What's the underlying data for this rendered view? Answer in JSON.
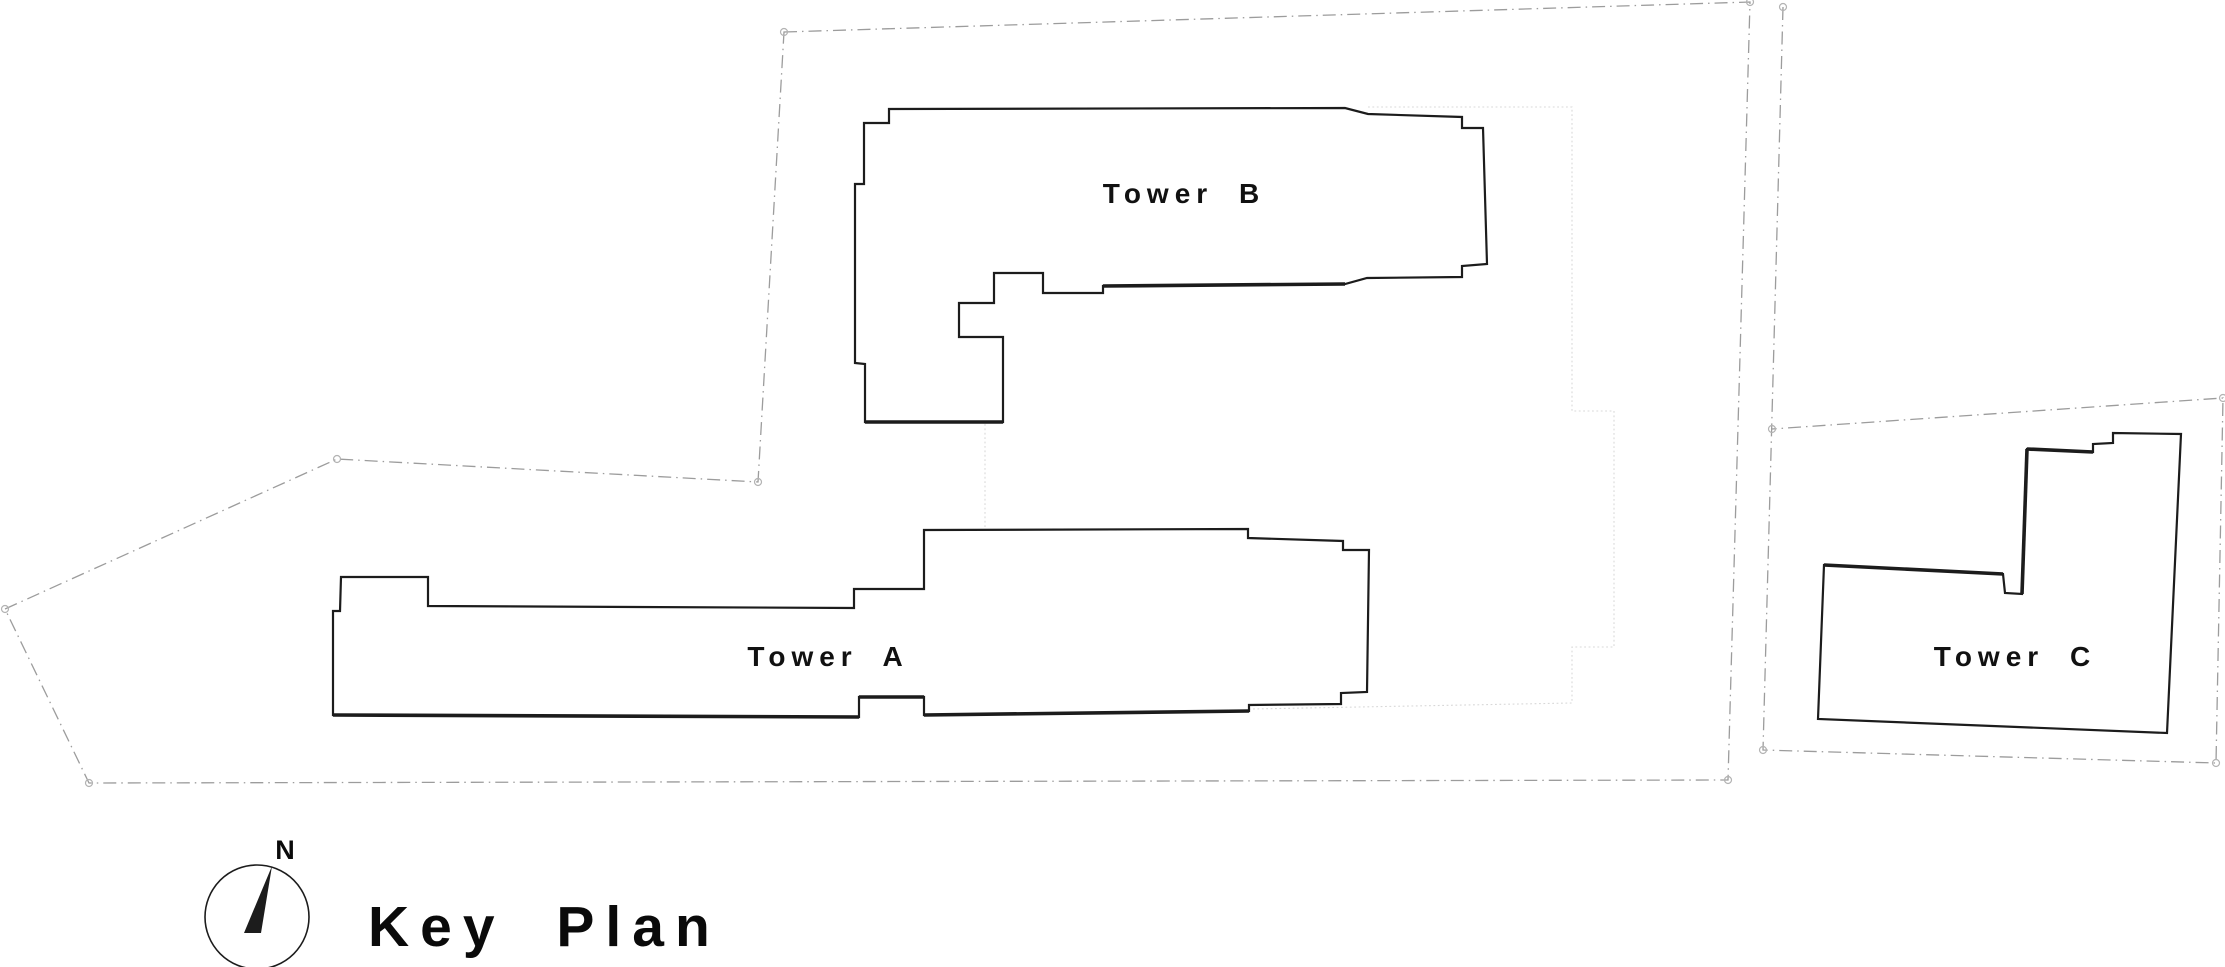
{
  "page": {
    "title": "Key Plan"
  },
  "plan": {
    "background": "#ffffff",
    "colors": {
      "building_stroke": "#1c1c1c",
      "building_fill": "#ffffff",
      "boundary_stroke": "#9c9c9c",
      "marker_stroke": "#b3b3b3",
      "podium_stroke": "#d8d8d8",
      "text": "#111111"
    },
    "boundaries": [
      {
        "id": "site-boundary-main",
        "closed": true,
        "points": [
          [
            784,
            32
          ],
          [
            1750,
            2
          ],
          [
            1728,
            780
          ],
          [
            89,
            783
          ],
          [
            5,
            609
          ],
          [
            337,
            459
          ],
          [
            758,
            482
          ]
        ]
      },
      {
        "id": "site-boundary-east",
        "closed": false,
        "points": [
          [
            1783,
            7
          ],
          [
            1763,
            750
          ],
          [
            2216,
            763
          ],
          [
            2223,
            398
          ],
          [
            1772,
            429
          ]
        ]
      }
    ],
    "podium_lines": [
      [
        [
          1368,
          107
        ],
        [
          1572,
          107
        ],
        [
          1572,
          411
        ],
        [
          1614,
          411
        ],
        [
          1614,
          647
        ],
        [
          1572,
          647
        ],
        [
          1572,
          703
        ],
        [
          985,
          714
        ]
      ],
      [
        [
          985,
          424
        ],
        [
          985,
          529
        ]
      ]
    ],
    "towers": [
      {
        "id": "tower-a",
        "label": "Tower A",
        "label_x": 828,
        "label_y": 666,
        "points": [
          [
            341,
            577
          ],
          [
            428,
            577
          ],
          [
            428,
            606
          ],
          [
            854,
            608
          ],
          [
            854,
            589
          ],
          [
            924,
            589
          ],
          [
            924,
            530
          ],
          [
            1248,
            529
          ],
          [
            1248,
            538
          ],
          [
            1343,
            541
          ],
          [
            1343,
            550
          ],
          [
            1369,
            550
          ],
          [
            1367,
            692
          ],
          [
            1341,
            693
          ],
          [
            1341,
            704
          ],
          [
            1249,
            705
          ],
          [
            1249,
            711
          ],
          [
            984,
            714
          ],
          [
            924,
            715
          ],
          [
            924,
            697
          ],
          [
            859,
            697
          ],
          [
            859,
            717
          ],
          [
            333,
            715
          ],
          [
            333,
            611
          ],
          [
            340,
            611
          ]
        ]
      },
      {
        "id": "tower-b",
        "label": "Tower B",
        "label_x": 1184,
        "label_y": 203,
        "points": [
          [
            889,
            109
          ],
          [
            1345,
            108
          ],
          [
            1368,
            114
          ],
          [
            1462,
            117
          ],
          [
            1462,
            128
          ],
          [
            1483,
            128
          ],
          [
            1487,
            264
          ],
          [
            1462,
            266
          ],
          [
            1462,
            277
          ],
          [
            1367,
            278
          ],
          [
            1345,
            284
          ],
          [
            1103,
            286
          ],
          [
            1103,
            293
          ],
          [
            1043,
            293
          ],
          [
            1043,
            273
          ],
          [
            994,
            273
          ],
          [
            994,
            303
          ],
          [
            959,
            303
          ],
          [
            959,
            337
          ],
          [
            1003,
            337
          ],
          [
            1003,
            422
          ],
          [
            865,
            422
          ],
          [
            865,
            364
          ],
          [
            855,
            363
          ],
          [
            855,
            184
          ],
          [
            864,
            184
          ],
          [
            864,
            123
          ],
          [
            889,
            123
          ]
        ]
      },
      {
        "id": "tower-c",
        "label": "Tower C",
        "label_x": 2015,
        "label_y": 666,
        "points": [
          [
            2027,
            449
          ],
          [
            2093,
            452
          ],
          [
            2093,
            444
          ],
          [
            2113,
            443
          ],
          [
            2113,
            433
          ],
          [
            2181,
            434
          ],
          [
            2167,
            733
          ],
          [
            1818,
            719
          ],
          [
            1824,
            565
          ],
          [
            2003,
            574
          ],
          [
            2005,
            593
          ],
          [
            2022,
            594
          ]
        ]
      }
    ],
    "heavy_edges": [
      [
        [
          865,
          422
        ],
        [
          1003,
          422
        ]
      ],
      [
        [
          1103,
          286
        ],
        [
          1345,
          284
        ]
      ],
      [
        [
          333,
          715
        ],
        [
          859,
          717
        ]
      ],
      [
        [
          859,
          697
        ],
        [
          924,
          697
        ]
      ],
      [
        [
          924,
          715
        ],
        [
          1249,
          711
        ]
      ],
      [
        [
          1824,
          565
        ],
        [
          2003,
          574
        ]
      ],
      [
        [
          2022,
          594
        ],
        [
          2027,
          449
        ]
      ],
      [
        [
          2027,
          449
        ],
        [
          2093,
          452
        ]
      ]
    ],
    "survey_markers": [
      [
        784,
        32
      ],
      [
        1750,
        2
      ],
      [
        1728,
        780
      ],
      [
        89,
        783
      ],
      [
        5,
        609
      ],
      [
        337,
        459
      ],
      [
        758,
        482
      ],
      [
        1783,
        7
      ],
      [
        1763,
        750
      ],
      [
        2216,
        763
      ],
      [
        2223,
        398
      ],
      [
        1772,
        429
      ]
    ],
    "compass": {
      "north_label": "N",
      "cx": 257,
      "cy": 917,
      "r": 52,
      "needle": [
        [
          272,
          866
        ],
        [
          244,
          933
        ],
        [
          261,
          933
        ]
      ],
      "label_x": 285,
      "label_y": 859
    }
  }
}
